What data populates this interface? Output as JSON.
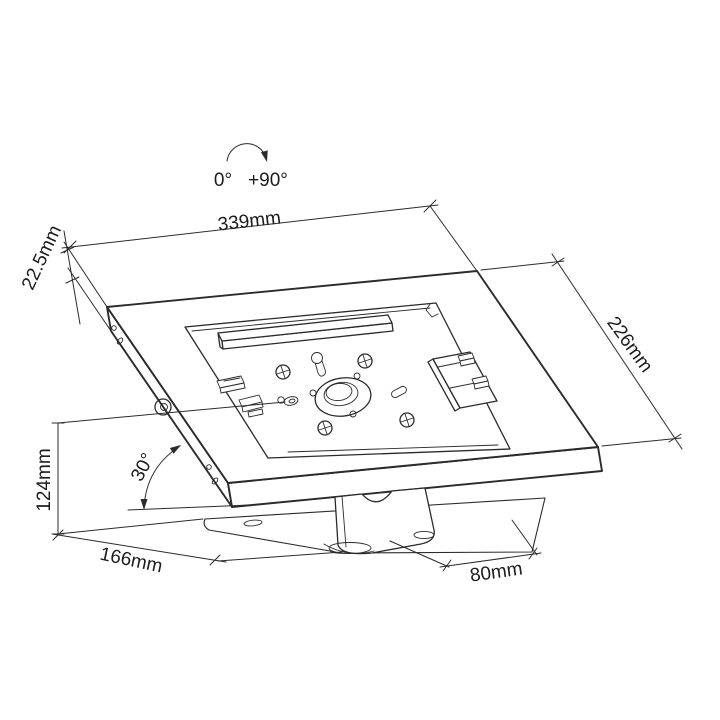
{
  "drawing": {
    "background_color": "#ffffff",
    "line_color": "#2b2b2b",
    "rotation_indicator": {
      "start_label": "0°",
      "end_label": "+90°"
    },
    "dimensions": {
      "top_width": {
        "label": "339mm"
      },
      "edge_thickness": {
        "label": "22.5mm"
      },
      "side_depth": {
        "label": "226mm"
      },
      "tilt_angle": {
        "label": "30°"
      },
      "stand_height": {
        "label": "124mm"
      },
      "base_depth": {
        "label": "166mm"
      },
      "base_width": {
        "label": "80mm"
      }
    }
  }
}
